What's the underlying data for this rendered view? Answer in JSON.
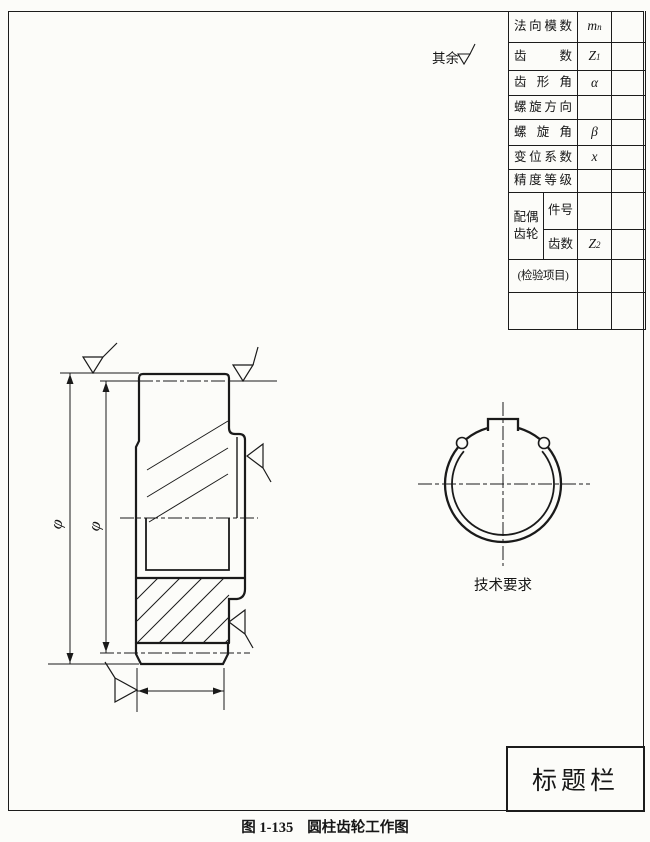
{
  "surface_note": {
    "label": "其余"
  },
  "param_table": {
    "rows": [
      {
        "label": "法向模数",
        "sym": "m",
        "sub": "n"
      },
      {
        "label": "齿数",
        "sym": "Z",
        "sub": "1"
      },
      {
        "label": "齿形角",
        "sym": "α",
        "sub": ""
      },
      {
        "label": "螺旋方向",
        "sym": "",
        "sub": ""
      },
      {
        "label": "螺旋角",
        "sym": "β",
        "sub": ""
      },
      {
        "label": "变位系数",
        "sym": "x",
        "sub": ""
      },
      {
        "label": "精度等级",
        "sym": "",
        "sub": ""
      }
    ],
    "mate": {
      "line1": "配偶",
      "line2": "齿轮",
      "row_a_label": "件号",
      "row_a_sym": "",
      "row_a_sub": "",
      "row_b_label": "齿数",
      "row_b_sym": "Z",
      "row_b_sub": "2"
    },
    "inspection": "(检验项目)"
  },
  "drawing": {
    "dim1": "φ",
    "dim2": "φ",
    "tech_req": "技术要求"
  },
  "title_block": {
    "label": "标题栏"
  },
  "caption": {
    "number": "图 1-135",
    "title": "圆柱齿轮工作图"
  }
}
